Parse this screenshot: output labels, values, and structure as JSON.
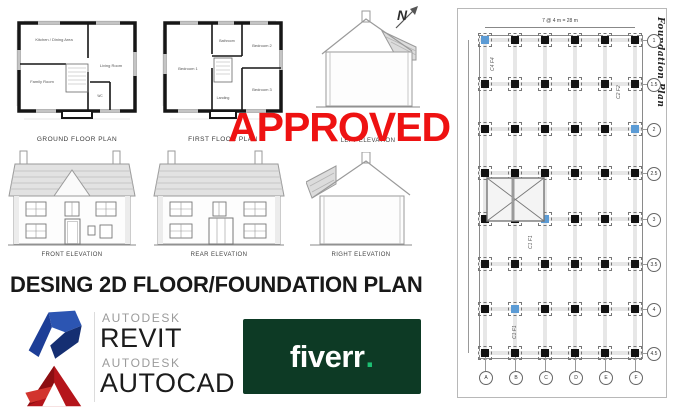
{
  "stamp": {
    "text": "APPROVED",
    "color": "#ee1212"
  },
  "headline": "DESING 2D FLOOR/FOUNDATION PLAN",
  "north_label": "N",
  "plans": {
    "ground": {
      "caption": "GROUND FLOOR PLAN",
      "rooms": {
        "kitchen": "Kitchen / Dining Area",
        "living": "Living Room",
        "family": "Family Room",
        "wc": "WC"
      }
    },
    "first": {
      "caption": "FIRST FLOOR PLAN",
      "rooms": {
        "bed1": "Bedroom 1",
        "bath": "Bathroom",
        "bed2": "Bedroom 2",
        "bed3": "Bedroom 3",
        "landing": "Landing"
      }
    }
  },
  "elevations": {
    "left": "LEFT ELEVATION",
    "front": "FRONT ELEVATION",
    "rear": "REAR ELEVATION",
    "right": "RIGHT ELEVATION"
  },
  "logos": {
    "revit": {
      "brand": "AUTODESK",
      "product": "REVIT"
    },
    "autocad": {
      "brand": "AUTODESK",
      "product": "AUTOCAD"
    },
    "fiverr": {
      "word": "fiverr",
      "dot": ".",
      "bg": "#0d3a25",
      "dot_color": "#1dbf73"
    }
  },
  "foundation_plan": {
    "title": "Foundation Plan",
    "top_dimension": "7 @ 4 m = 28 m",
    "row_bubbles": [
      "1",
      "1.5",
      "2",
      "2.5",
      "3",
      "3.5",
      "4",
      "4.5"
    ],
    "col_bubbles": [
      "A",
      "B",
      "C",
      "D",
      "E",
      "F"
    ],
    "column_labels": [
      "C4 F4",
      "C2 F2",
      "C1 F1",
      "C1 F1"
    ],
    "colors": {
      "column": "#111111",
      "highlight": "#5b9bd5"
    }
  }
}
